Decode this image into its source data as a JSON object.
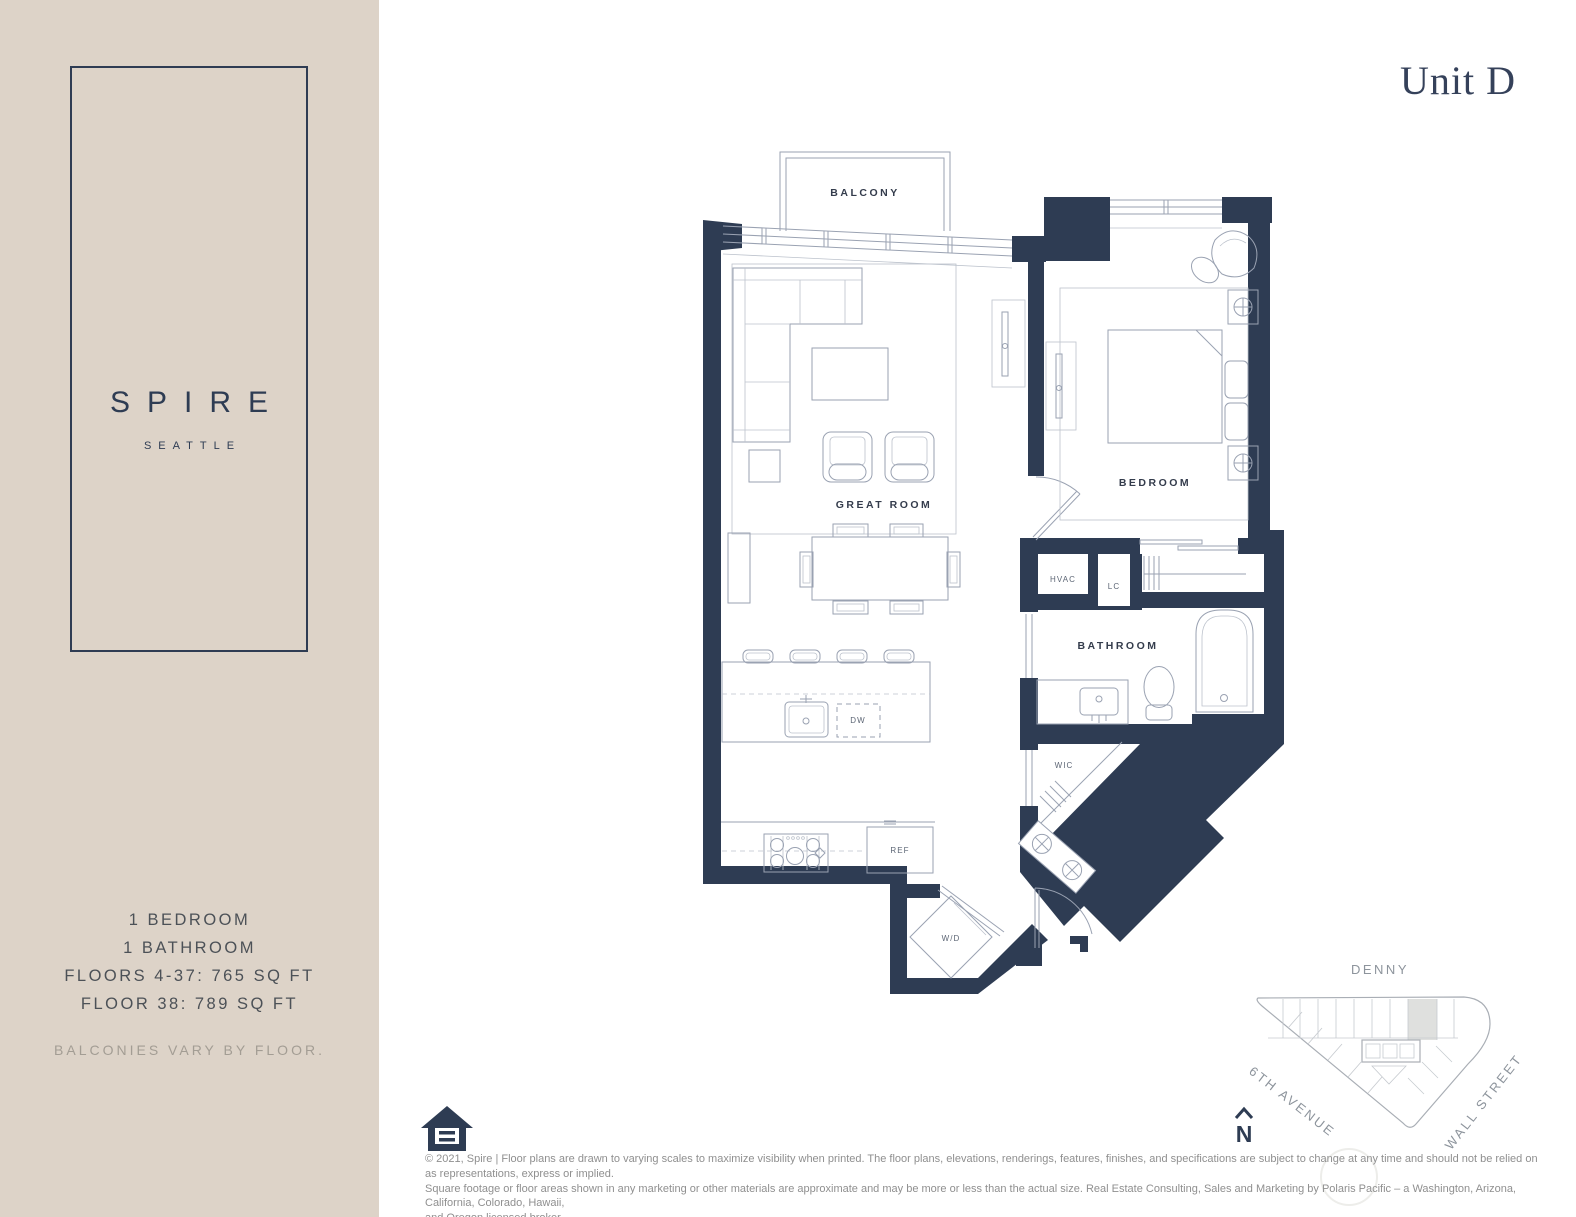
{
  "colors": {
    "wall": "#2e3c53",
    "sidebar_bg": "#ddd3c8",
    "line": "#9aa2b2",
    "line_light": "#bcc2cc",
    "label": "#343c4c",
    "label_small": "#5d6675",
    "muted": "#a39d94",
    "gray_text": "#8f8f8f",
    "map_gray": "#8d949c",
    "highlight": "#dfe0de"
  },
  "header": {
    "unit_title": "Unit D"
  },
  "sidebar": {
    "brand": "SPIRE",
    "brand_sub": "SEATTLE",
    "details": [
      "1 BEDROOM",
      "1 BATHROOM",
      "FLOORS 4-37: 765 SQ FT",
      "FLOOR 38: 789 SQ FT"
    ],
    "note": "BALCONIES VARY BY FLOOR."
  },
  "plan": {
    "labels": {
      "balcony": "BALCONY",
      "great_room": "GREAT ROOM",
      "bedroom": "BEDROOM",
      "bathroom": "BATHROOM",
      "hvac": "HVAC",
      "lc": "LC",
      "wic": "WIC",
      "wd": "W/D",
      "ref": "REF",
      "dw": "DW"
    }
  },
  "sitemap": {
    "street_top": "DENNY",
    "street_left": "6TH AVENUE",
    "street_right": "WALL STREET",
    "north_label": "N"
  },
  "footer": {
    "disclaimer": [
      "© 2021, Spire | Floor plans are drawn to varying scales to maximize visibility when printed. The floor plans, elevations, renderings, features, finishes, and specifications are subject to change at any time and should not be relied on as representations, express or implied.",
      "Square footage or floor areas shown in any marketing or other materials are approximate and may be more or less than the actual size. Real Estate Consulting, Sales and Marketing by Polaris Pacific – a Washington, Arizona, California, Colorado, Hawaii,",
      "and Oregon licensed broker."
    ]
  }
}
